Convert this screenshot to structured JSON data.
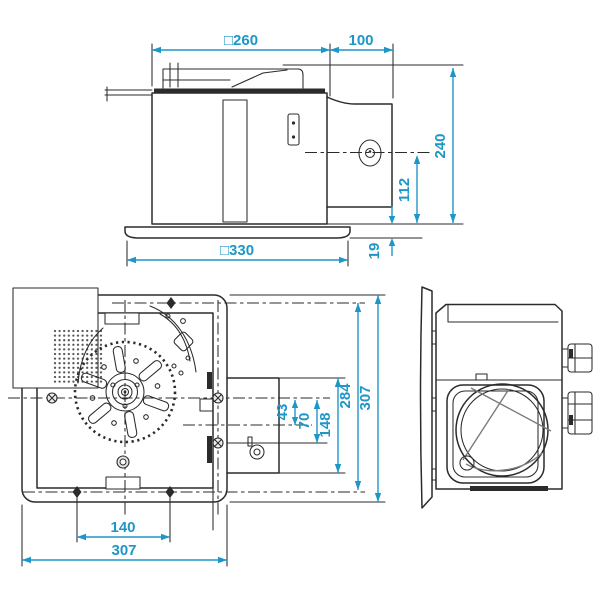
{
  "drawing": {
    "type": "ventilation-fan-dimensional-drawing",
    "line_color": "#2b2b2b",
    "dim_color": "#1e96c8",
    "background": "#ffffff"
  },
  "dims": {
    "front": {
      "body_width": "□260",
      "duct_length": "100",
      "overall_height": "240",
      "duct_center_height": "112",
      "grille_width": "□330",
      "grille_thickness": "19"
    },
    "plan": {
      "duct_center_offset": "43",
      "duct_lower_offset": "70",
      "duct_opening": "148",
      "mount_pitch_vertical": "284",
      "body_depth": "307",
      "mount_pitch_horizontal": "140",
      "body_width": "307"
    }
  }
}
